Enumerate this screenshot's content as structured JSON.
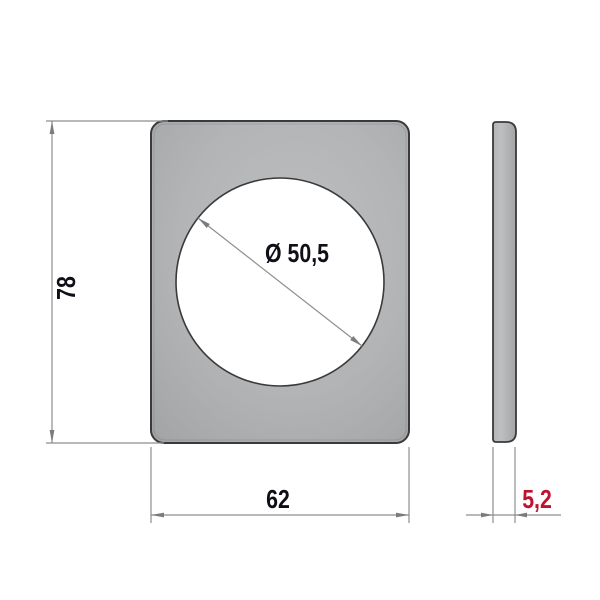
{
  "drawing": {
    "type": "technical-dimension-drawing",
    "views": {
      "front": "plate-with-round-hole",
      "side": "plate-thickness-profile"
    }
  },
  "dimensions": {
    "height": {
      "label": "78"
    },
    "width": {
      "label": "62"
    },
    "hole_diameter": {
      "label": "Ø 50,5"
    },
    "thickness": {
      "label": "5,2"
    }
  },
  "colors": {
    "background": "#ffffff",
    "part_fill": "#b2b4b6",
    "part_fill_light": "#bdbfc1",
    "part_fill_dark": "#a2a4a6",
    "part_outline": "#3a3a3c",
    "hole_fill": "#ffffff",
    "dimension_line": "#8e8e8e",
    "dimension_arrow": "#7c7c7c",
    "dimension_text": "#0f0f17",
    "thickness_text": "#c1122d"
  }
}
